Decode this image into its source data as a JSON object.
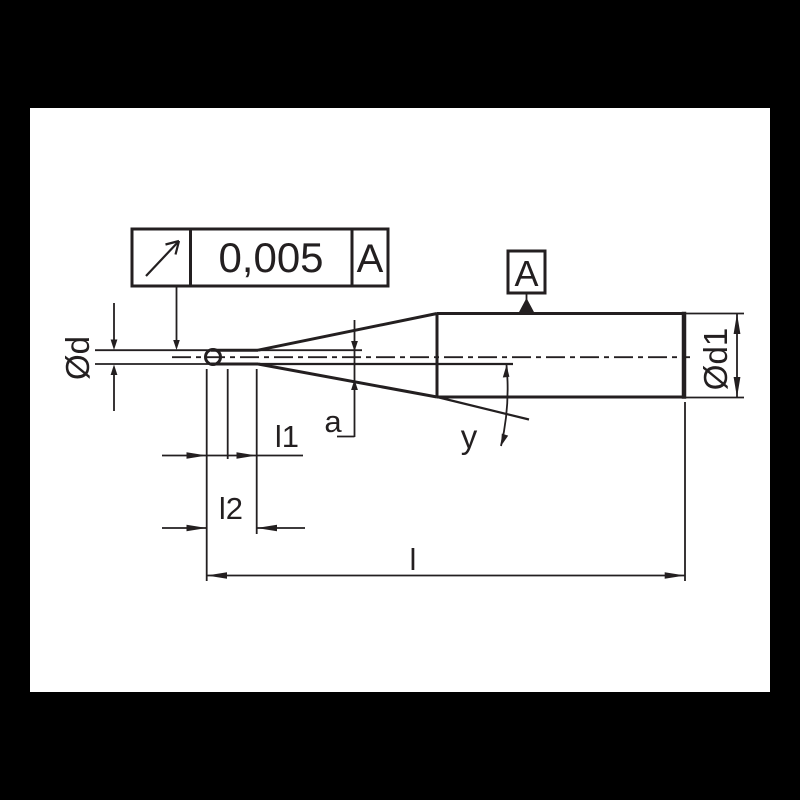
{
  "colors": {
    "background": "#000000",
    "canvas": "#ffffff",
    "line": "#231f20"
  },
  "tolerance_frame": {
    "symbol": "circular-runout",
    "value": "0,005",
    "datum": "A"
  },
  "datum_flag": {
    "label": "A"
  },
  "dim_labels": {
    "d": "Ød",
    "d1": "Ød1",
    "l1": "l1",
    "l2": "l2",
    "l": "l",
    "a": "a",
    "y": "y"
  }
}
